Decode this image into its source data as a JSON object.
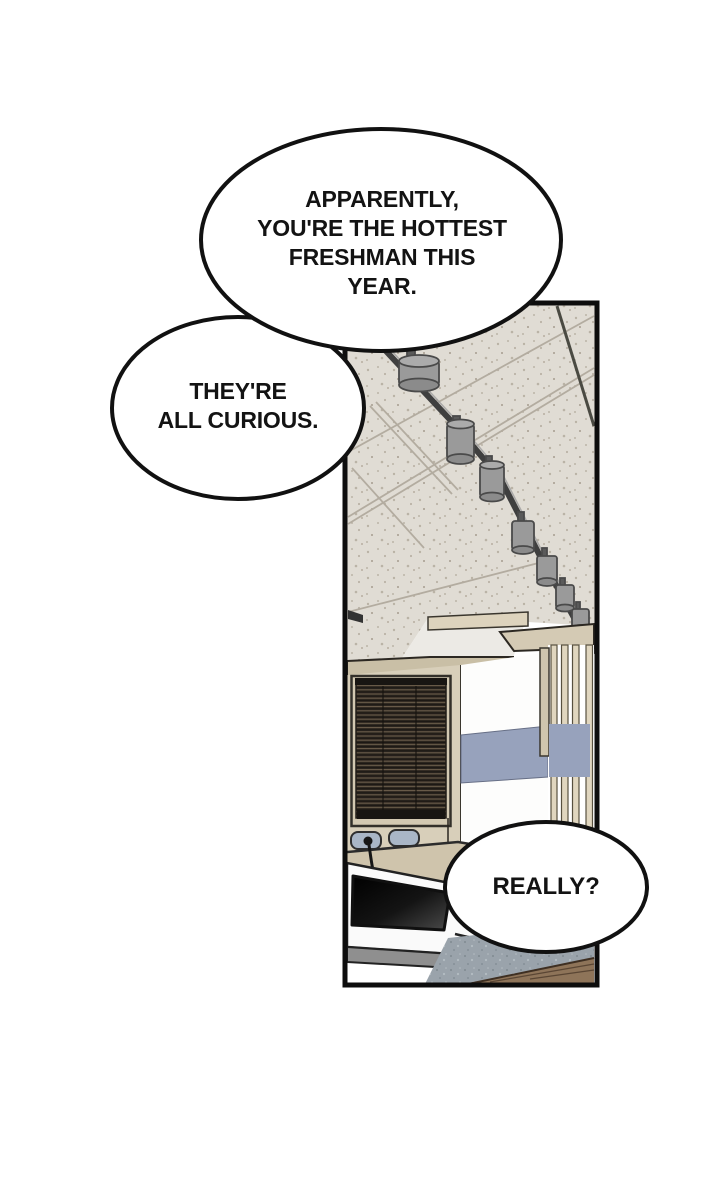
{
  "bubbles": {
    "b1": {
      "lines": [
        "APPARENTLY,",
        "YOU'RE THE HOTTEST",
        "FRESHMAN THIS",
        "YEAR."
      ]
    },
    "b2": {
      "lines": [
        "THEY'RE",
        "ALL CURIOUS."
      ]
    },
    "b3": {
      "lines": [
        "REALLY?"
      ]
    }
  },
  "colors": {
    "outline": "#111111",
    "panel_border": "#0d0d0d",
    "ceiling": "#e0dcd4",
    "ceiling_line": "#b3aca0",
    "recess_white": "#eceae5",
    "beam_tan": "#c9bfa6",
    "fascia_tan": "#d4cab4",
    "shelf_tan": "#ddd3bd",
    "wall_tan": "#d8cfba",
    "window_frame": "#d3c9b2",
    "blinds_dark": "#2a241e",
    "blind_slat_line": "#6b5d4a",
    "wall_white": "#fdfdfc",
    "stripe_blue": "#97a2bc",
    "slat_beige": "#e0d6bf",
    "chair_blue": "#a9b6c6",
    "counter_tan": "#cfc4ac",
    "rail_gray": "#3f3f3f",
    "light_gray": "#9a9a9a",
    "lectern_white": "#fafafa",
    "lectern_gray": "#8f8f8f",
    "floor_gray": "#9aa3ab",
    "wood_brown": "#8e7459",
    "bubble_fill": "#ffffff",
    "text": "#131313"
  }
}
